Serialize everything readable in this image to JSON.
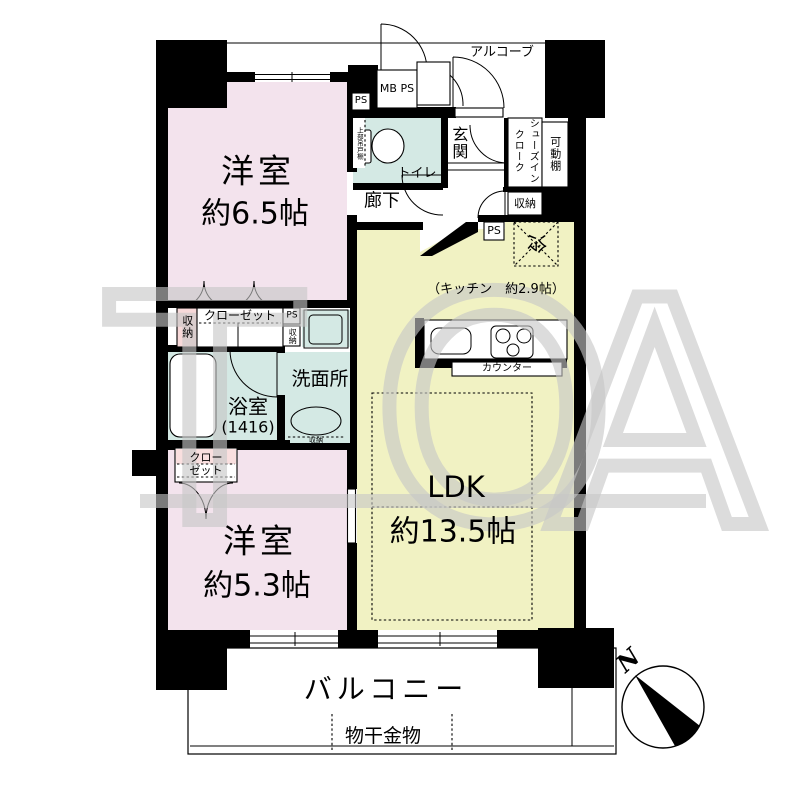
{
  "watermark": {
    "text": "TOA",
    "t": "T",
    "o": "O",
    "a": "A"
  },
  "compass": {
    "north": "N"
  },
  "labels": {
    "alcove": "アルコーブ",
    "mb_ps": "MB PS",
    "ps": "PS",
    "entrance": "玄関",
    "sic_col_left": "クローク",
    "sic_col_right": "シューズイン",
    "movable_shelf": "可動棚",
    "toilet": "トイレ",
    "upper_cabinet": "上部吊戸棚",
    "hallway": "廊下",
    "storage": "収納",
    "fridge": "冷",
    "kitchen_caption": "（キッチン　約2.9帖）",
    "counter": "カウンター",
    "closet": "クローゼット",
    "closet_line1": "クロー",
    "closet_line2": "ゼット",
    "washroom": "洗面所",
    "bath": "浴室",
    "bath_size": "(1416)",
    "room1_name": "洋室",
    "room1_size": "約6.5帖",
    "room2_name": "洋室",
    "room2_size": "約5.3帖",
    "ldk_name": "LDK",
    "ldk_size": "約13.5帖",
    "balcony": "バルコニー",
    "laundry_fitting": "物干金物"
  },
  "colors": {
    "room-pink": "#f3e3ed",
    "ldk-yellow": "#f1f2c3",
    "wet-cyan": "#d4e9e4",
    "storage-pink": "#f8d9d9",
    "wall-black": "#000000",
    "watermark-gray": "#c7c7c7"
  }
}
